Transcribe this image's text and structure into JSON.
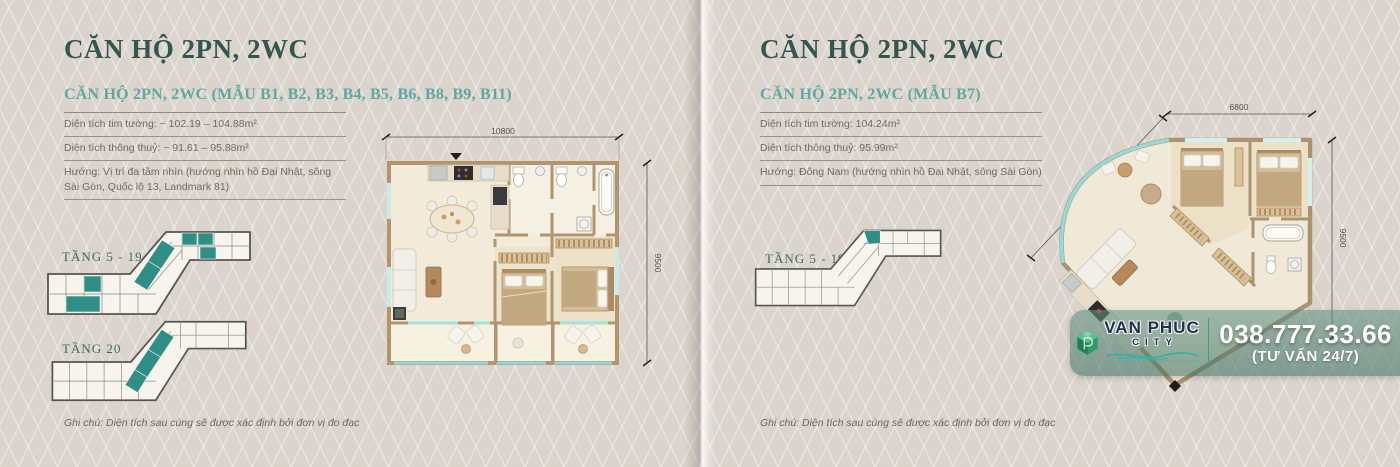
{
  "page": {
    "panels": [
      {
        "title": "CĂN HỘ 2PN, 2WC",
        "subtitle": "CĂN HỘ 2PN, 2WC (MẪU B1, B2, B3, B4, B5, B6, B8, B9, B11)",
        "specs": [
          "Diện tích tim tường: ~ 102.19 – 104.88m²",
          "Diện tích thông thuỷ: ~ 91.61 – 95.88m²",
          "Hướng: Vị trí đa tầm nhìn (hướng nhìn hồ Đại Nhật, sông Sài Gòn, Quốc lộ 13, Landmark 81)"
        ],
        "floor_diagrams": [
          {
            "label": "TẦNG 5 - 19"
          },
          {
            "label": "TẦNG 20"
          }
        ],
        "plan_dimensions": {
          "top": "10800",
          "right": "9500"
        },
        "note": "Ghi chú: Diện tích sau cùng sẽ được xác định bởi đơn vị đo đạc"
      },
      {
        "title": "CĂN HỘ 2PN, 2WC",
        "subtitle": "CĂN HỘ 2PN, 2WC (MẪU B7)",
        "specs": [
          "Diện tích tim tường: 104.24m²",
          "Diện tích thông thuỷ: 95.99m²",
          "Hướng: Đông Nam (hướng nhìn hồ Đại Nhật, sông Sài Gòn)"
        ],
        "floor_diagrams": [
          {
            "label": "TẦNG 5 - 19"
          }
        ],
        "plan_dimensions": {
          "top": "6800",
          "left": "8500",
          "right": "9500"
        },
        "note": "Ghi chú: Diện tích sau cùng sẽ được xác định bởi đơn vị đo đạc"
      }
    ],
    "badge": {
      "brand": "VAN PHUC",
      "brand_sub": "CITY",
      "phone": "038.777.33.66",
      "phone_sub": "(TƯ VẤN 24/7)"
    },
    "colors": {
      "accent_teal": "#2f8e85",
      "title_green": "#35564f",
      "subtitle_teal": "#5fa7a2",
      "glass_teal": "#8fd9da",
      "badge_teal": "#4f8677",
      "brand_navy": "#22304f",
      "wall_tan": "#ad9270"
    }
  }
}
